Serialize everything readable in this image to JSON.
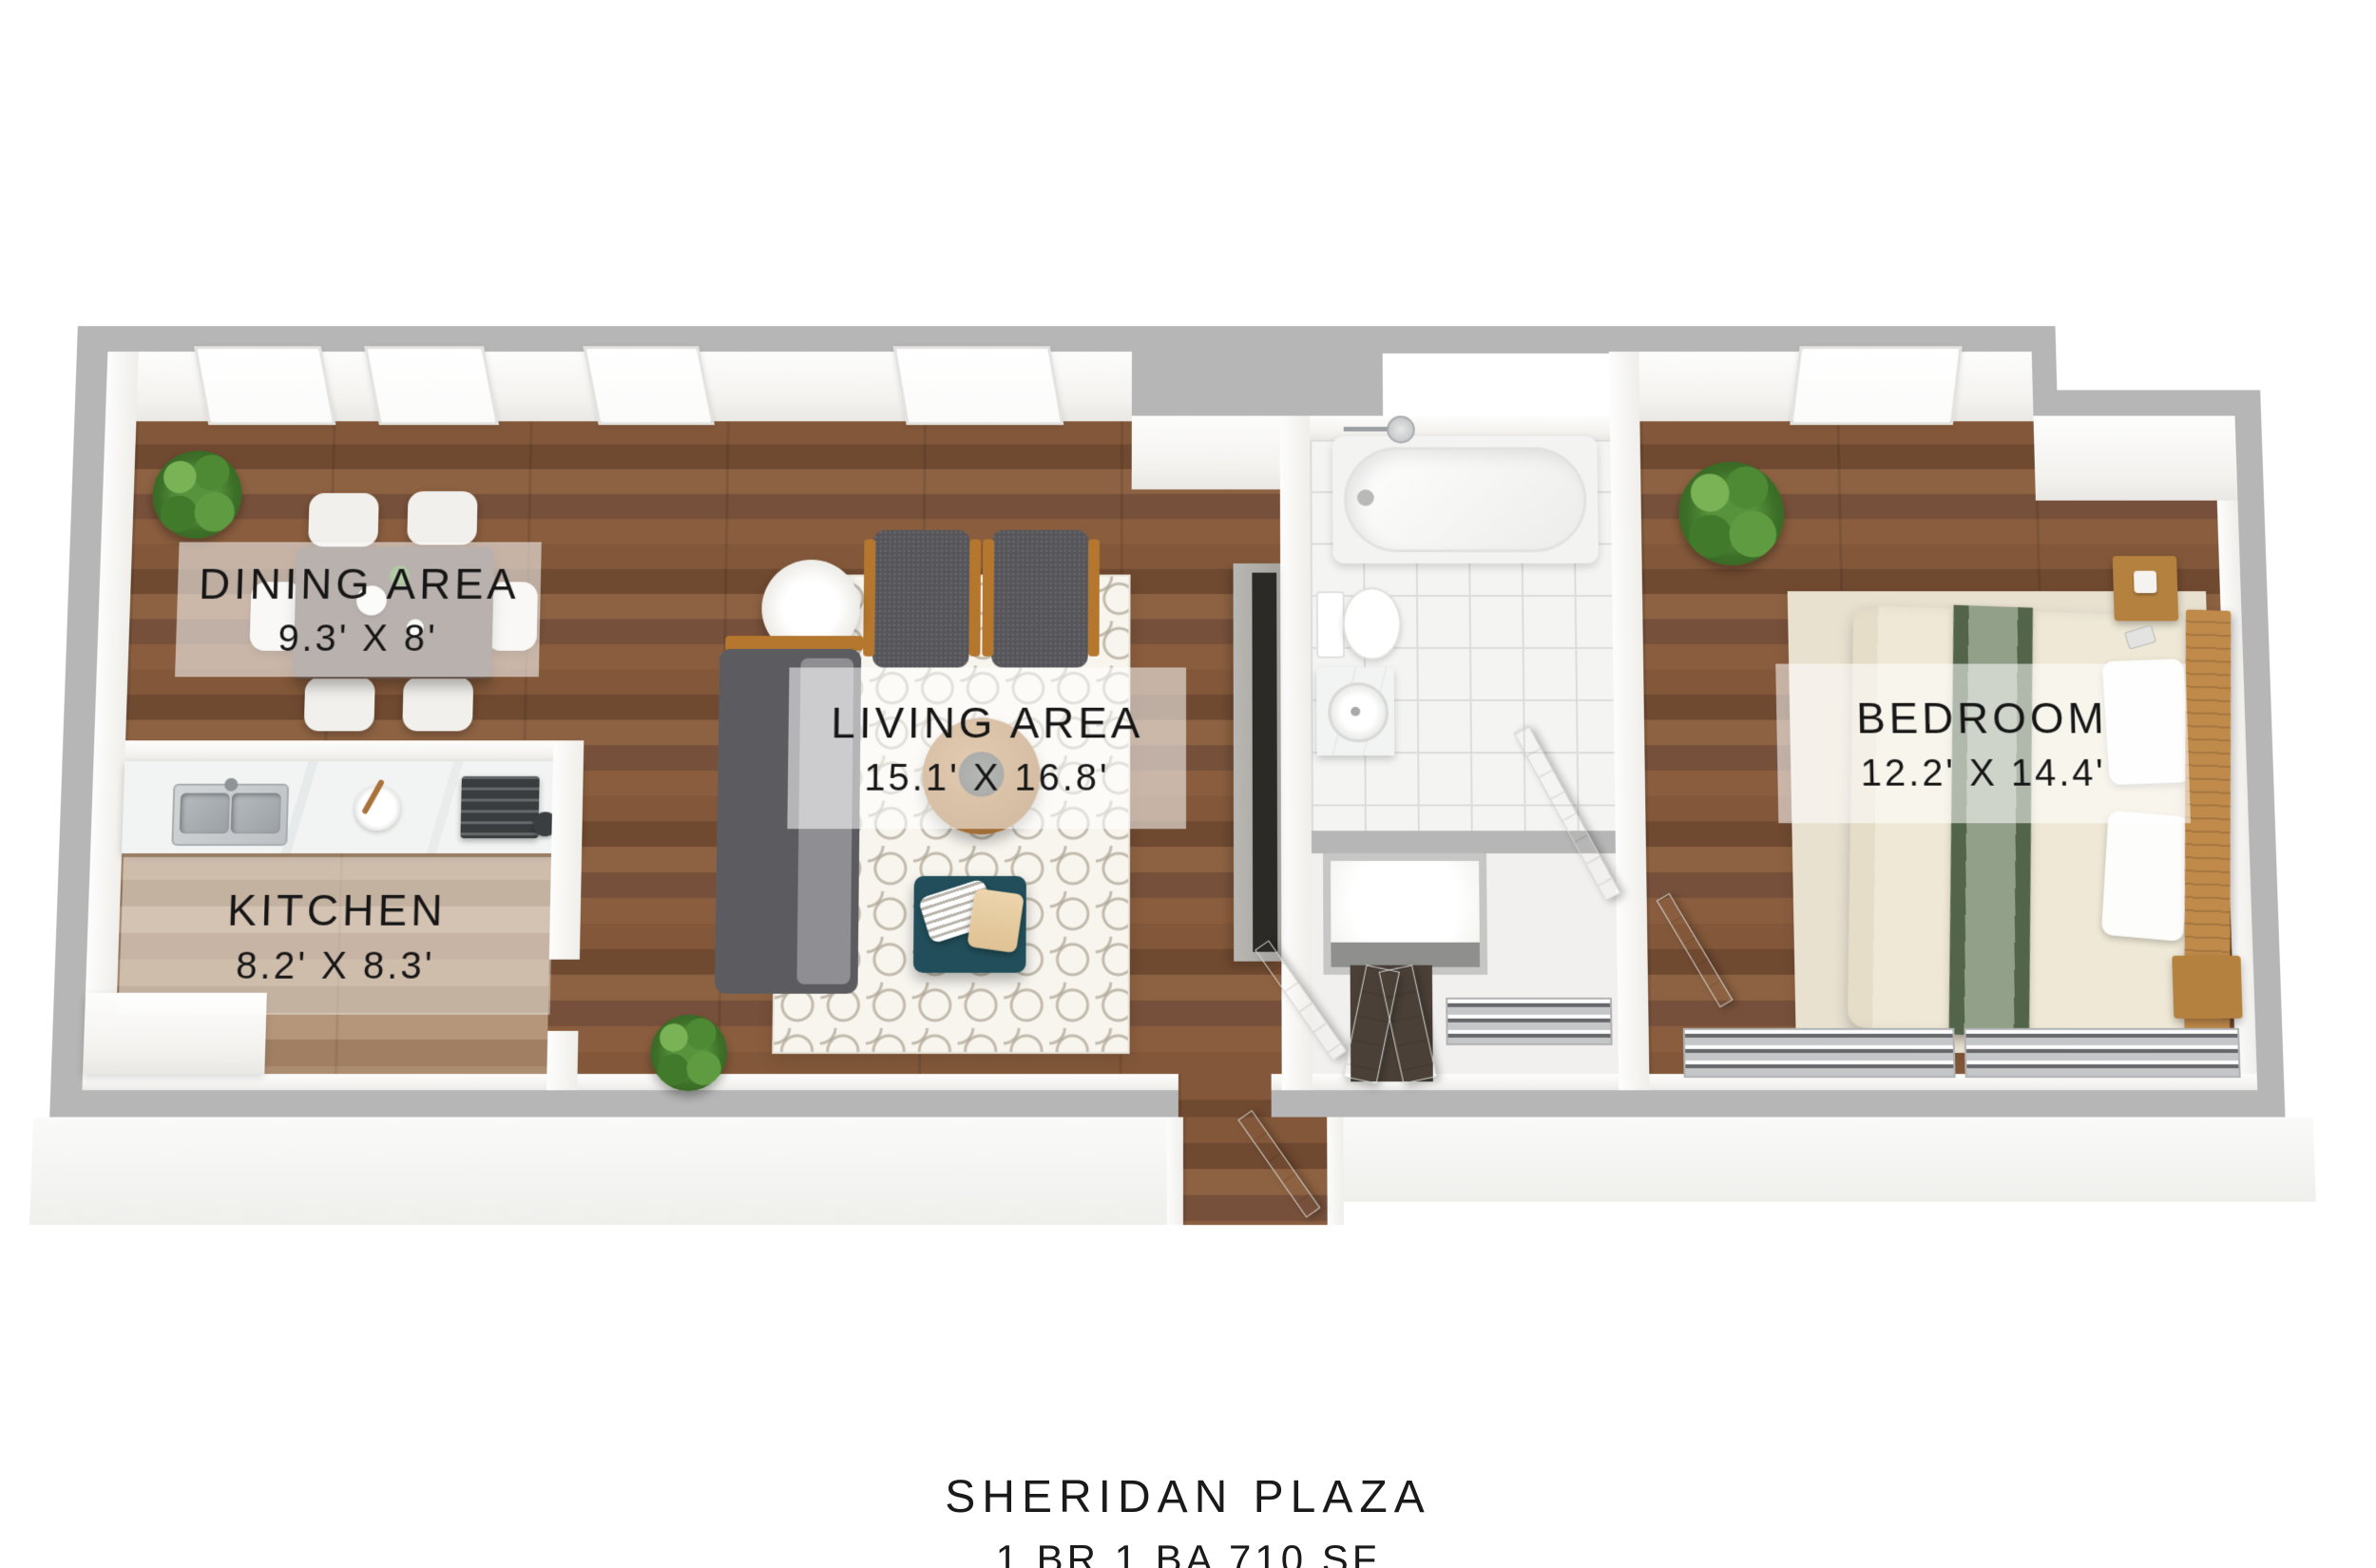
{
  "meta": {
    "type": "3d-floorplan-render"
  },
  "title": {
    "name": "SHERIDAN PLAZA",
    "details": "1 BR 1 BA 710 SF"
  },
  "rooms": [
    {
      "name": "DINING AREA",
      "dims": "9.3' X 8'"
    },
    {
      "name": "KITCHEN",
      "dims": "8.2' X 8.3'"
    },
    {
      "name": "LIVING AREA",
      "dims": "15.1' X 16.8'"
    },
    {
      "name": "BEDROOM",
      "dims": "12.2' X 14.4'"
    }
  ],
  "colors": {
    "wall_cut_gray": "#b6b6b6",
    "wall_face_white": "#f8f7f5",
    "wood_floor": "#7d5438",
    "kitchen_wood_floor": "#a8876b",
    "living_rug_white": "#f8f5ef",
    "bedroom_rug_beige": "#e9e1d0",
    "sofa_gray": "#5c5c60",
    "wood_accent": "#b5772e",
    "ottoman_teal": "#214e5a",
    "bed_linen_cream": "#efe8d6",
    "bed_runner_green": "#5a6b50",
    "plant_green": "#57923c",
    "bath_tile_white": "#f4f4f3",
    "label_text": "#161616",
    "label_bg": "rgba(255,255,255,0.55)"
  },
  "furniture": {
    "dining": [
      "dining-table",
      "dining-chair-x6",
      "potted-plant",
      "window-x3",
      "teapot-set"
    ],
    "kitchen": [
      "counter",
      "double-sink",
      "plate-with-spoon",
      "stove-cooktop",
      "corner-counter"
    ],
    "living": [
      "sofa",
      "armchair-x2",
      "floor-lamp",
      "patterned-area-rug",
      "round-coffee-table",
      "teal-ottoman",
      "throw-pillow",
      "potted-plant",
      "tv-console",
      "window"
    ],
    "bathroom": [
      "bathtub",
      "shower-head",
      "toilet",
      "vessel-sink-vanity",
      "linen-closet",
      "bathroom-door",
      "bifold-closet-door"
    ],
    "bedroom": [
      "bed",
      "green-runner-throw",
      "pillow-x2",
      "headboard",
      "nightstand-x2",
      "beige-area-rug",
      "potted-plant",
      "wire-shelf-closet",
      "bedroom-door",
      "window"
    ],
    "entry": [
      "entry-door",
      "wire-shelf-closet",
      "vestibule",
      "vestibule-door"
    ]
  }
}
